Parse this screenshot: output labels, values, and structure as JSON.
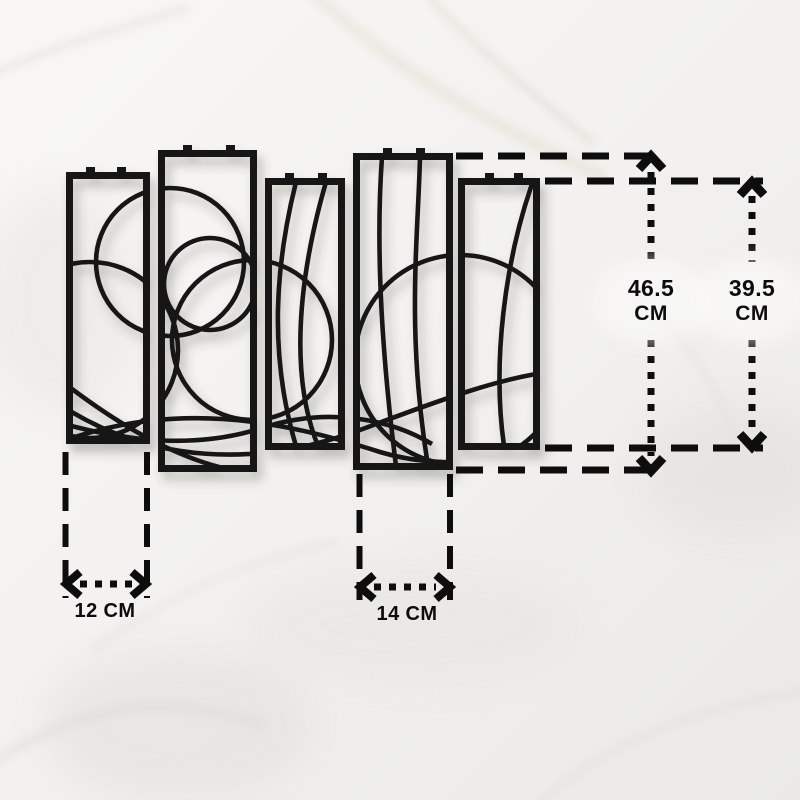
{
  "image": {
    "description": "Five-panel abstract metal wall art hung on a white marble wall, annotated with product dimensions",
    "panel_count": "5"
  },
  "annotations": {
    "height_left": {
      "value": "46.5",
      "unit": "CM"
    },
    "height_right": {
      "value": "39.5",
      "unit": "CM"
    },
    "width_left_panel": "12 CM",
    "width_center_panel": "14 CM"
  },
  "colors": {
    "artwork_black": "#131313",
    "annotation_black": "#0d0d0d",
    "wall_light": "#f3f2f0",
    "marble_vein": "#d8cfbd"
  }
}
